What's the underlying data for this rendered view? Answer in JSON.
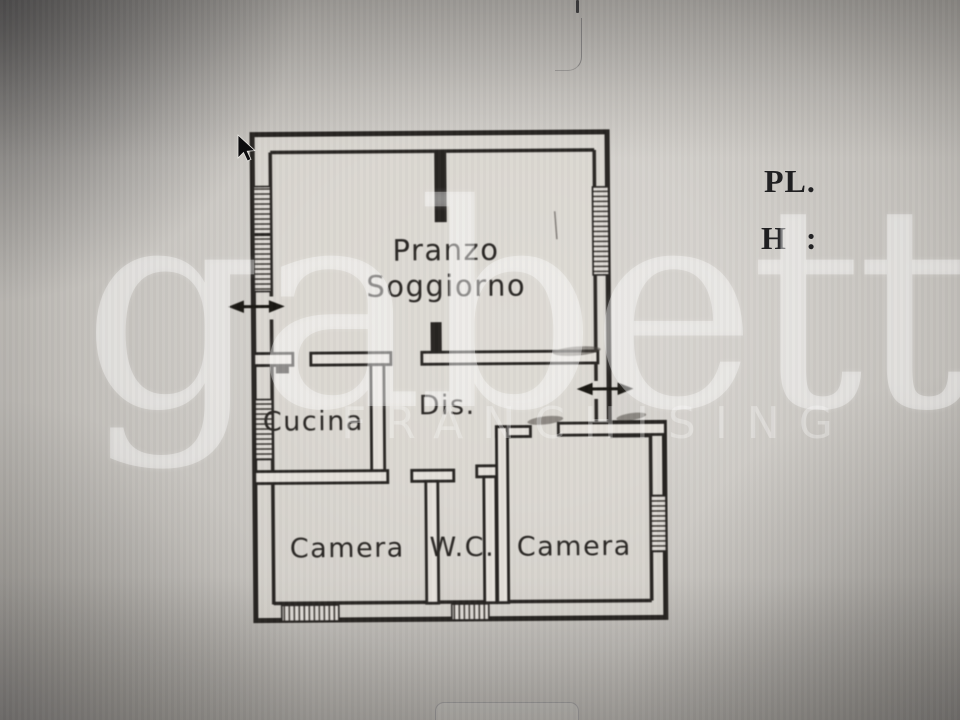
{
  "plan": {
    "labels": {
      "pranzo": "Pranzo",
      "soggiorno": "Soggiorno",
      "cucina": "Cucina",
      "dis": "Dis.",
      "camera_left": "Camera",
      "wc": "W.C.",
      "camera_right": "Camera"
    }
  },
  "annotations": {
    "floor": "PL.",
    "height": "H :"
  },
  "watermark": {
    "brand": "gabetti",
    "subtitle": "FRANCHISING"
  },
  "colors": {
    "wall_ink": "#24211e",
    "label_ink": "#262320",
    "annotation_ink": "#1b1b1d",
    "paper_center": "#dcd9d4",
    "background_edge": "#94918f",
    "watermark_white": "#ffffff"
  }
}
